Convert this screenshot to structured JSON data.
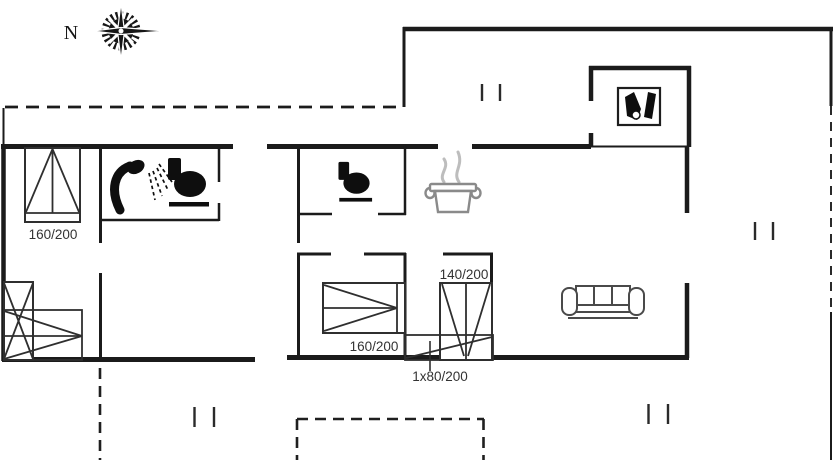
{
  "compass": {
    "label": "N"
  },
  "beds": {
    "left_double": {
      "label": "160/200"
    },
    "middle_double": {
      "label": "160/200"
    },
    "bunk": {
      "label": "140/200"
    },
    "single": {
      "label": "1x80/200"
    }
  },
  "icons": [
    "compass-rose-icon",
    "shower-icon",
    "toilet-icon",
    "cooking-pot-icon",
    "wood-stove-icon",
    "sofa-icon",
    "double-bed-icon",
    "bunk-bed-icon",
    "single-bed-icon",
    "vent-mark"
  ],
  "colors": {
    "wall": "#1b1b1b",
    "furniture_outline": "#2f2f2f",
    "pot_gray": "#8a8a8a",
    "steam_gray": "#bdbdbd",
    "sofa_gray": "#4a4a4a",
    "label_text": "#333333",
    "background": "#ffffff"
  }
}
